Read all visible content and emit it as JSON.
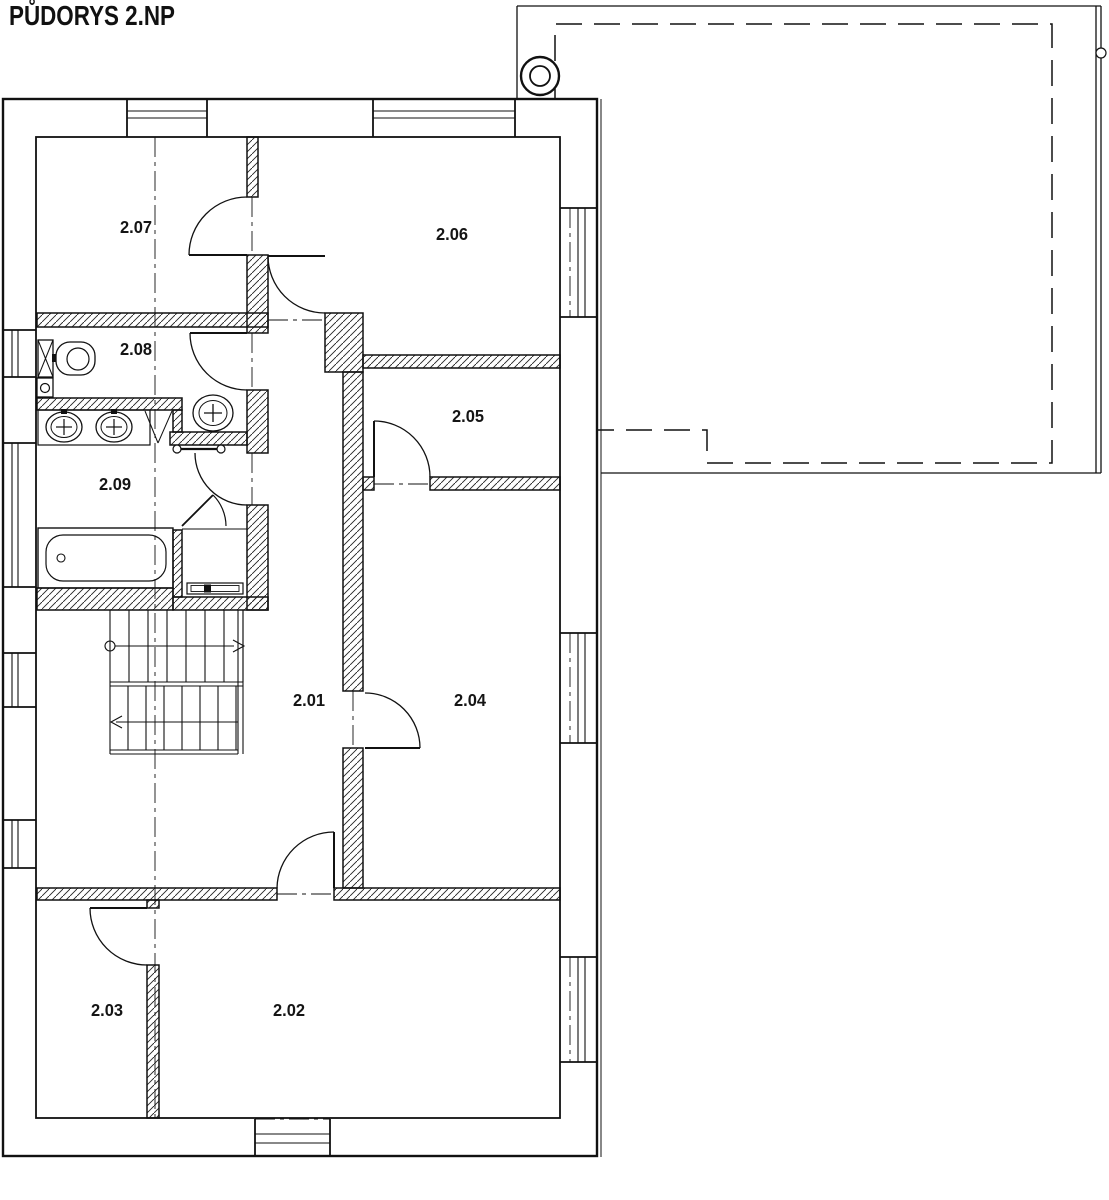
{
  "title": "PŮDORYS 2.NP",
  "rooms": [
    {
      "number": "2.01"
    },
    {
      "number": "2.02"
    },
    {
      "number": "2.03"
    },
    {
      "number": "2.04"
    },
    {
      "number": "2.05"
    },
    {
      "number": "2.06"
    },
    {
      "number": "2.07"
    },
    {
      "number": "2.08"
    },
    {
      "number": "2.09"
    }
  ],
  "colors": {
    "line": "#111111",
    "background": "#ffffff"
  }
}
